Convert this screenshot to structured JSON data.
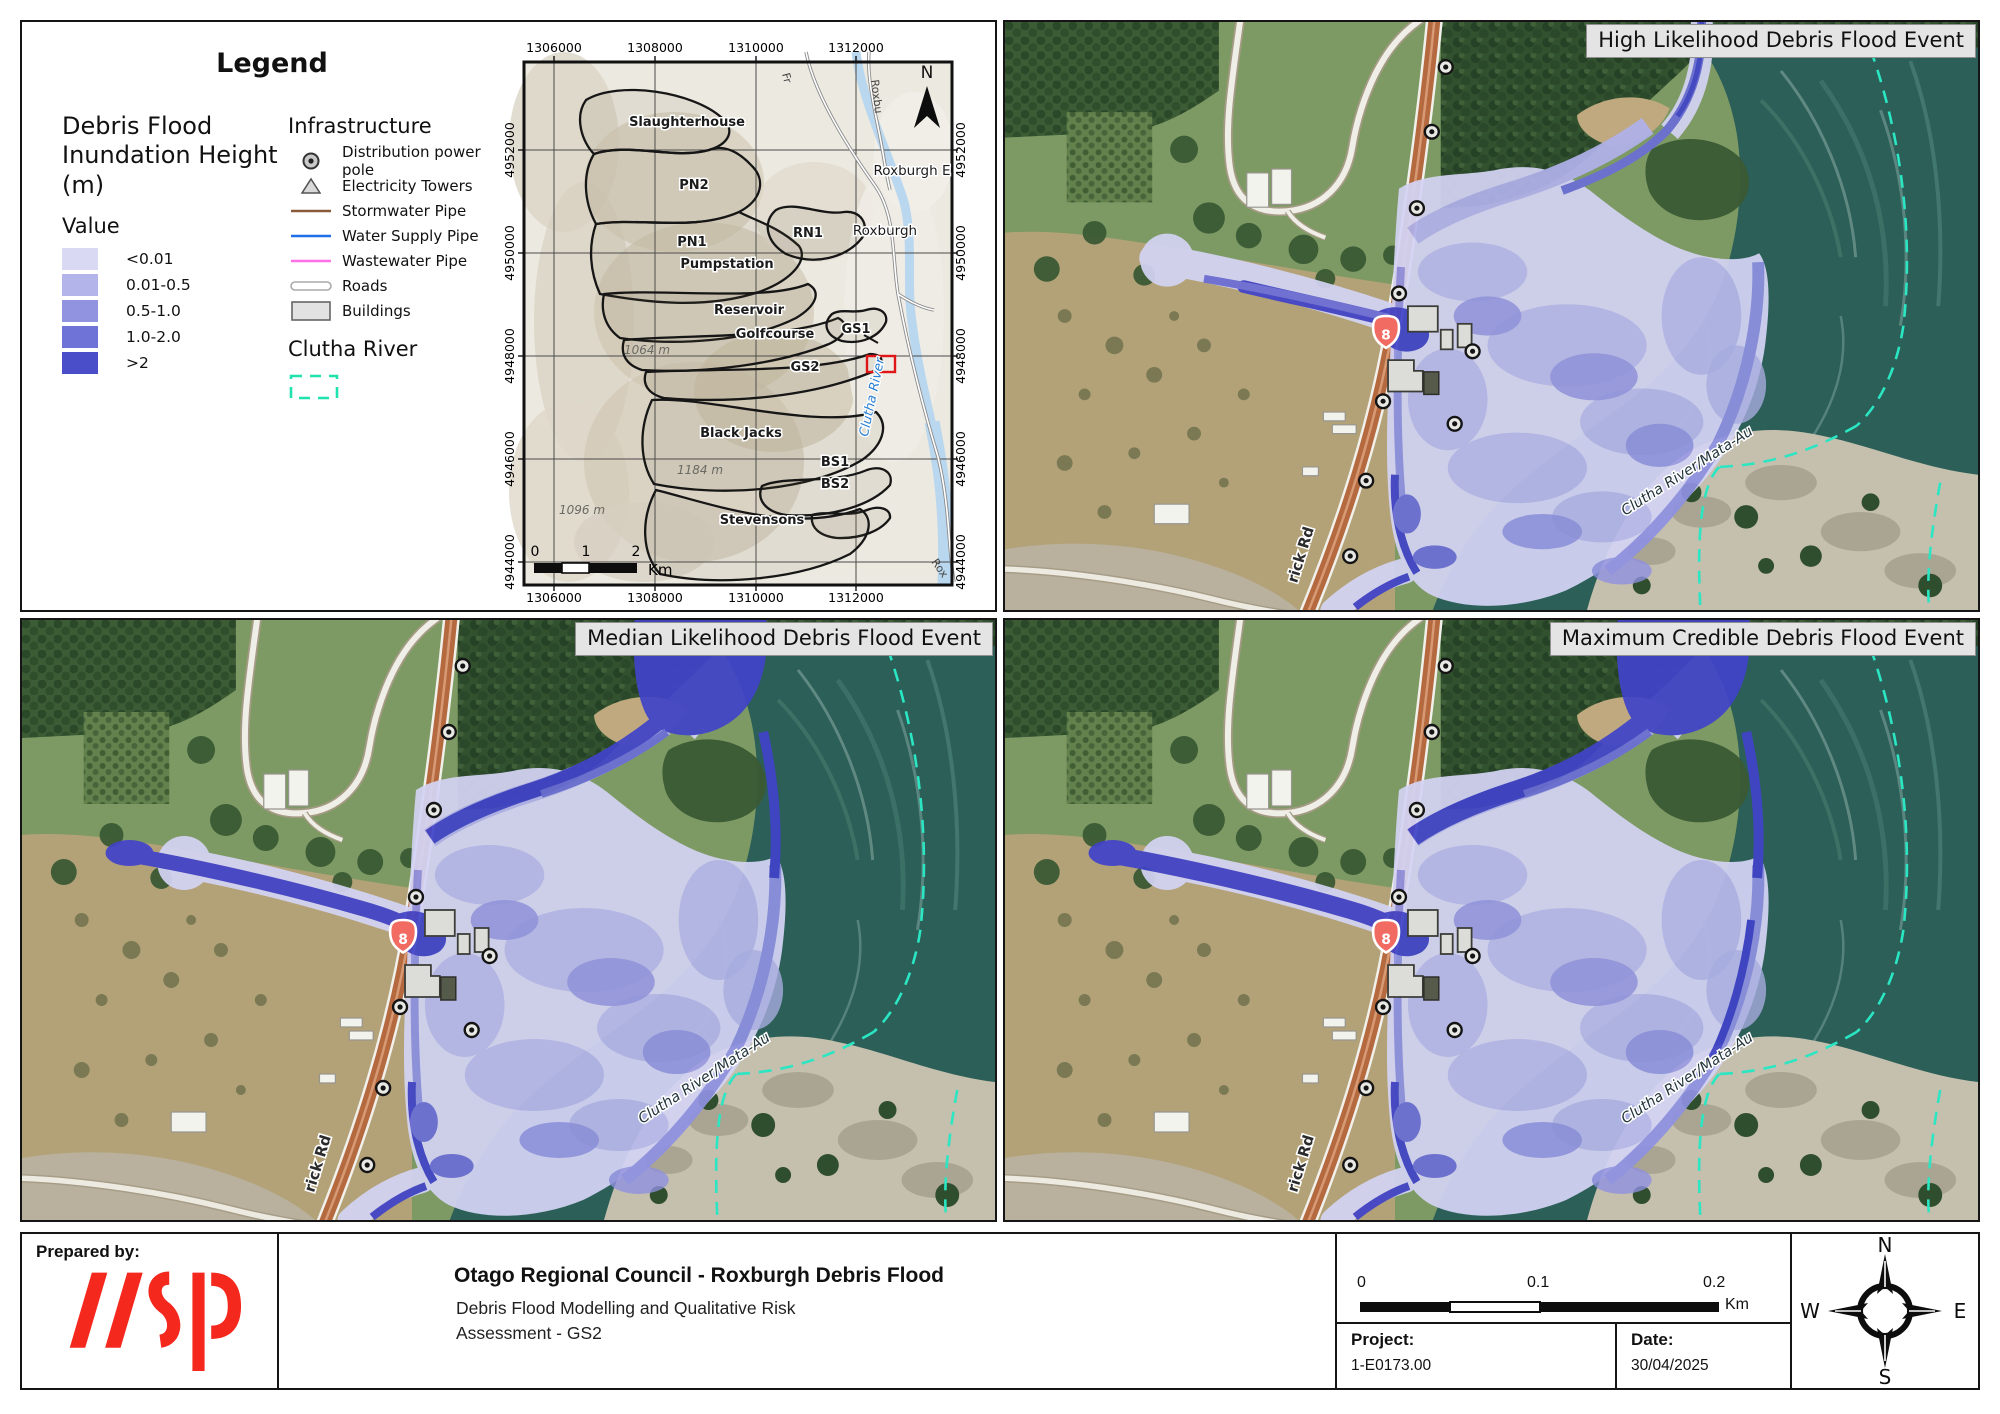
{
  "legend": {
    "title": "Legend",
    "flood_heading_lines": [
      "Debris Flood",
      "Inundation Height",
      "(m)"
    ],
    "value_label": "Value",
    "value_items": [
      {
        "label": "<0.01",
        "color": "#d9d9f4"
      },
      {
        "label": "0.01-0.5",
        "color": "#b3b4ea"
      },
      {
        "label": "0.5-1.0",
        "color": "#9193e0"
      },
      {
        "label": "1.0-2.0",
        "color": "#6f72d7"
      },
      {
        "label": ">2",
        "color": "#4b4ec9"
      }
    ],
    "infrastructure_heading": "Infrastructure",
    "infrastructure_items": [
      {
        "icon": "power-pole",
        "label": "Distribution power pole"
      },
      {
        "icon": "tower",
        "label": "Electricity Towers"
      },
      {
        "icon": "line-brown",
        "label": "Stormwater Pipe",
        "color": "#8a5a3b"
      },
      {
        "icon": "line-blue",
        "label": "Water Supply Pipe",
        "color": "#1f6fe8"
      },
      {
        "icon": "line-pink",
        "label": "Wastewater Pipe",
        "color": "#ff70e8"
      },
      {
        "icon": "road",
        "label": "Roads"
      },
      {
        "icon": "building",
        "label": "Buildings"
      }
    ],
    "clutha_heading": "Clutha River",
    "clutha_dash_color": "#1fe2ae"
  },
  "locator": {
    "x_ticks": [
      "1306000",
      "1308000",
      "1310000",
      "1312000"
    ],
    "y_ticks": [
      "4952000",
      "4950000",
      "4948000",
      "4946000",
      "4944000"
    ],
    "north_label": "N",
    "scale_ticks": [
      "0",
      "1",
      "2"
    ],
    "scale_unit": "Km",
    "catchment_labels": [
      {
        "text": "Slaughterhouse",
        "x": 163,
        "y": 64
      },
      {
        "text": "PN2",
        "x": 170,
        "y": 127
      },
      {
        "text": "PN1",
        "x": 168,
        "y": 184
      },
      {
        "text": "Pumpstation",
        "x": 203,
        "y": 206
      },
      {
        "text": "RN1",
        "x": 284,
        "y": 175
      },
      {
        "text": "Reservoir",
        "x": 225,
        "y": 252
      },
      {
        "text": "Golfcourse",
        "x": 251,
        "y": 276
      },
      {
        "text": "GS1",
        "x": 332,
        "y": 271
      },
      {
        "text": "GS2",
        "x": 281,
        "y": 309
      },
      {
        "text": "Black Jacks",
        "x": 217,
        "y": 375
      },
      {
        "text": "BS1",
        "x": 311,
        "y": 404
      },
      {
        "text": "BS2",
        "x": 311,
        "y": 426
      },
      {
        "text": "Stevensons",
        "x": 238,
        "y": 462
      }
    ],
    "place_labels": [
      {
        "text": "Roxburgh E",
        "x": 388,
        "y": 113
      },
      {
        "text": "Roxburgh",
        "x": 361,
        "y": 173
      }
    ],
    "elevation_labels": [
      {
        "text": "1064 m",
        "x": 123,
        "y": 292
      },
      {
        "text": "1184 m",
        "x": 176,
        "y": 412
      },
      {
        "text": "1096 m",
        "x": 58,
        "y": 452
      }
    ],
    "road_labels": [
      {
        "text": "Fr",
        "x": 258,
        "y": 12,
        "rot": 75
      },
      {
        "text": "Roxbu",
        "x": 347,
        "y": 18,
        "rot": 83
      },
      {
        "text": "Rox",
        "x": 407,
        "y": 500,
        "rot": 55
      }
    ],
    "river_label": "Clutha River"
  },
  "maps": [
    {
      "title": "High Likelihood Debris Flood Event",
      "variant": "high"
    },
    {
      "title": "Median Likelihood Debris Flood Event",
      "variant": "median"
    },
    {
      "title": "Maximum Credible Debris Flood Event",
      "variant": "max"
    }
  ],
  "map_common": {
    "shield_number": "8",
    "road_label": "rick Rd",
    "river_label": "Clutha River/Mata-Au"
  },
  "flood_palette": {
    "lt001": "#d4d4f4",
    "lt05": "#b0b1ea",
    "lt10": "#8f91e1",
    "lt20": "#6b6ed7",
    "gt2": "#4144c9"
  },
  "accent_colors": {
    "clutha_boundary": "#2ae6c3",
    "highway_shield": "#f26b63",
    "extent_box": "#e01515",
    "wsp_red": "#f5281e"
  },
  "footer": {
    "prepared_label": "Prepared by:",
    "logo_name": "wsp",
    "title": "Otago Regional Council - Roxburgh Debris Flood",
    "subtitle_line1": "Debris Flood Modelling and Qualitative Risk",
    "subtitle_line2": "Assessment - GS2",
    "scalebar_ticks": [
      "0",
      "0.1",
      "0.2"
    ],
    "scalebar_unit": "Km",
    "project_label": "Project:",
    "project_value": "1-E0173.00",
    "date_label": "Date:",
    "date_value": "30/04/2025",
    "compass": {
      "n": "N",
      "e": "E",
      "s": "S",
      "w": "W"
    }
  }
}
